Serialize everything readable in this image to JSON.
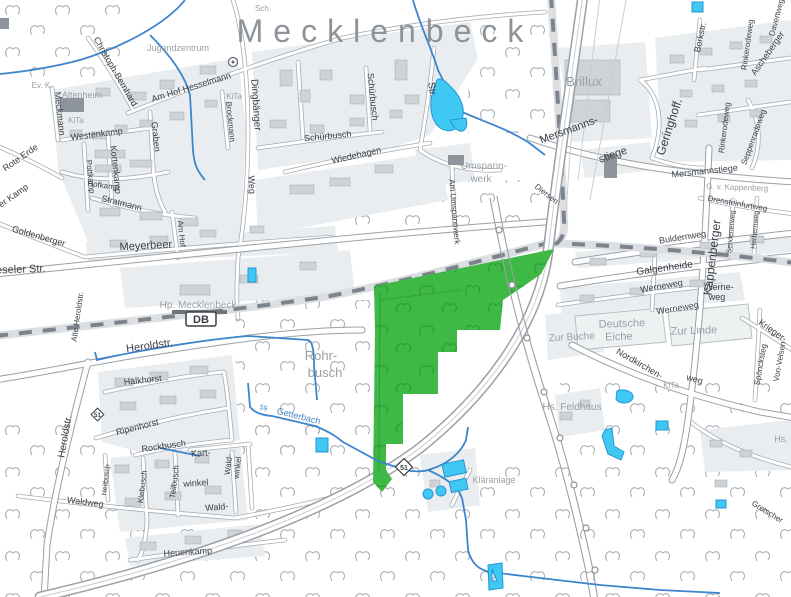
{
  "title": "Mecklenbeck",
  "badges": {
    "db": "DB",
    "b51": "51",
    "b51_small": "51"
  },
  "colors": {
    "highlight_green": "#3eb946",
    "highlight_tree_green": "#2f9c39",
    "water_fill": "#3fc8f2",
    "water_line": "#3d85cc",
    "label_gray": "#9aa0a6",
    "label_dark": "#3a3f45",
    "label_blue": "#3f86c8"
  },
  "labels": {
    "brillux": "Brillux",
    "mersmanns_a": "Mersmanns-",
    "mersmanns_b": "stiege",
    "geringhoff": "Geringhoff.",
    "borkstr": "Borkstr.",
    "davertweg": "Davertweg",
    "ascheberger": "Ascheberger",
    "rinkerodeweg_1": "Rinkerodeweg",
    "rinkerodeweg_2": "Rinkerodeweg",
    "seppenradeweg": "Seppenradeweg",
    "mersmannstiege": "Mersmannstiege",
    "gut_kappenberg": "G. v. Kappenberg",
    "drensteinfurtweg": "Drensteinfurtweg",
    "kappenberger": "Kappenberger",
    "sendenerweg": "Sendenerweg",
    "herbernweg": "Herbernweg",
    "buldernweg": "Buldernweg",
    "galgenheide": "Galgenheide",
    "werneweg_1": "Werneweg",
    "werneweg_2a": "Werne-",
    "werneweg_2b": "weg",
    "werneweg_3": "Werneweg",
    "deutsche_eiche_1": "Deutsche",
    "deutsche_eiche_2": "Eiche",
    "zur_linde": "Zur Linde",
    "zur_buche": "Zur Buche",
    "krieger": "Krieger-",
    "sponcksteg": "Spöncksteg",
    "von_velsen": "Von-Velsen",
    "nordkirchen_a": "Nordkirchen-",
    "nordkirchen_b": "weg",
    "kita_east": "KiTa",
    "hs_east": "Hs.",
    "gretscher": "Gretscher",
    "hs_feldhaus": "Hs. Feldhaus",
    "klaeranlage": "Kläranlage",
    "getterbach_km": "59",
    "getterbach": "Getterbach",
    "rohrbusch_a": "Rohr-",
    "rohrbusch_b": "busch",
    "heroldstr_h": "Heroldstr.",
    "heroldstr_v": "Heroldstr.",
    "halkhorst": "Halkhorst",
    "ripenhorst": "Ripenhorst",
    "rockbusch": "Rockbusch",
    "kiebusch": "Kiebusch",
    "heitbusch": "Heitbusch",
    "teilbusch": "Teilbusch",
    "kartwinkel_a": "Kart-",
    "kartwinkel_b": "winkel",
    "waldwinkel_a": "Wald-",
    "waldwinkel_b": "winkel",
    "wald": "Wald-",
    "waldweg": "Waldweg",
    "heuenkamp": "Heuenkamp",
    "weseler_str": "Weseler Str.",
    "alte_heroldstr": "Alte Heroldstr.",
    "hp_mecklenbeck": "Hp. Mecklenbeck",
    "meyerbeer": "Meyerbeer",
    "am_umspannwerk": "Am Umspannwerk",
    "umspannwerk_a": "Umspann-",
    "umspannwerk_b": "werk",
    "jugendzentrum": "Jugendzentrum",
    "altenheim": "Altenheim",
    "ev_k": "Ev. K.",
    "kita_1": "KiTa",
    "kita_2": "KiTa",
    "sch": "Sch.",
    "dingbaenger": "Dingbänger",
    "dingbaenger_weg": "Weg",
    "schuerbusch_v": "Schürbusch",
    "schuerbusch_h": "Schürbusch",
    "wiedehagen": "Wiedehagen",
    "str_v": "Str.",
    "am_hof_hesselmann": "Am Hof Hesselmann",
    "graben": "Graben",
    "christoph_bernhard": "Christoph-Bernhard",
    "meckmann": "Meckmann",
    "rote_erde": "Rote Erde",
    "westenkamp": "Westenkamp",
    "kortenkamp": "Kortenkamp",
    "pottkamp": "Pottkamp",
    "hofkamp": "Hofkamp",
    "stratmann": "Stratmann",
    "am_hof": "Am Hof",
    "brockmann": "Brockmann",
    "goldenberger": "Goldenberger",
    "er_kamp": "er Kamp",
    "diersen": "Diersen"
  }
}
